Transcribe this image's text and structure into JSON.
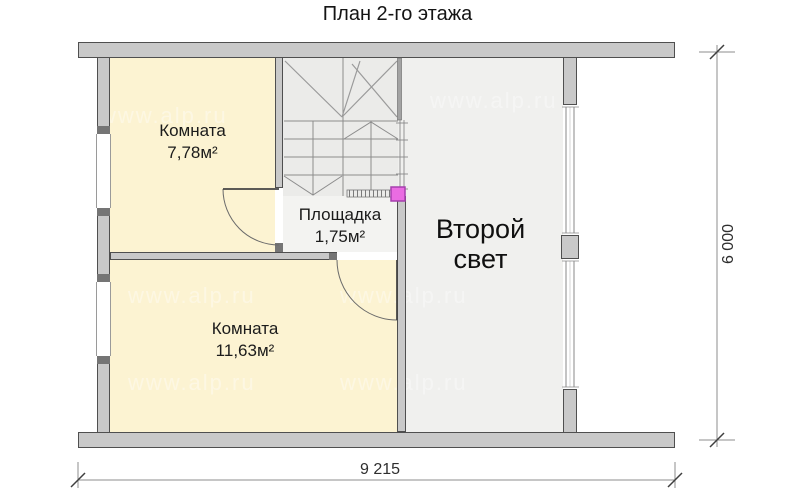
{
  "title": "План 2-го этажа",
  "plan": {
    "room_top": {
      "name": "Комната",
      "area": "7,78м²"
    },
    "room_bottom": {
      "name": "Комната",
      "area": "11,63м²"
    },
    "landing": {
      "name": "Площадка",
      "area": "1,75м²"
    },
    "void_space": {
      "line1": "Второй",
      "line2": "свет"
    }
  },
  "dimensions": {
    "width": "9 215",
    "height": "6 000"
  },
  "watermark": "www.alp.ru",
  "colors": {
    "wall_fill": "#c9c9c9",
    "room_fill": "#fcf3d2",
    "void_fill": "#f0f0ee",
    "newel_post_accent": "#ea6ce2"
  }
}
